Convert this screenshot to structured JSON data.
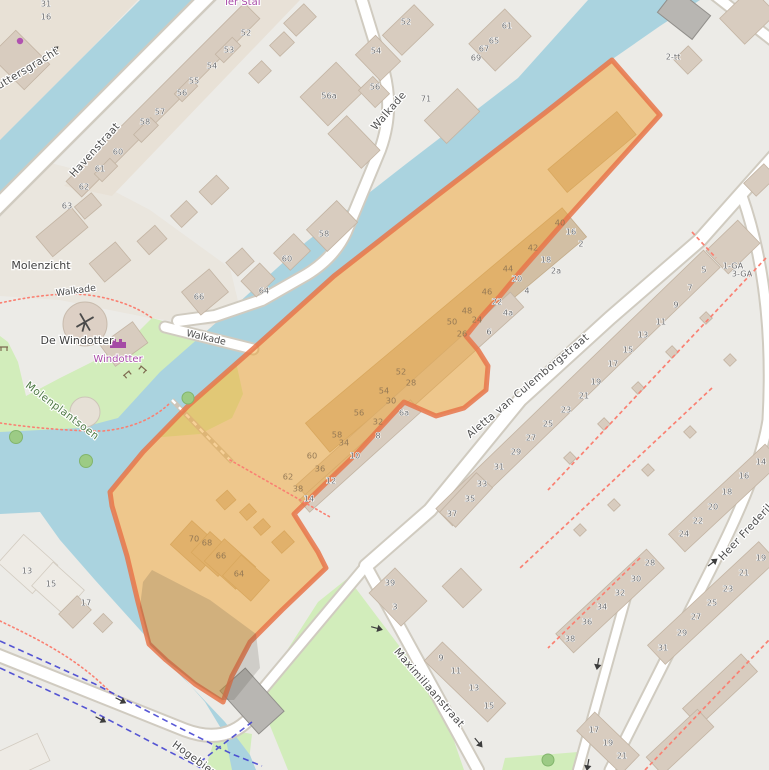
{
  "map": {
    "type": "openstreetmap-with-selection",
    "selection": {
      "name": "highlighted-area",
      "fill": "#f0a431",
      "stroke": "#e8764a"
    },
    "colors": {
      "water": "#aad3df",
      "park": "#d2edbb",
      "land": "#ecebe7",
      "residential": "#e7ddd0",
      "building": "#d8ccbf",
      "building_outline": "#c3b4a3",
      "road": "#ffffff",
      "road_casing": "#d0cbc0",
      "bridge": "#b8b6b2",
      "footpath_red": "#fa8072",
      "cycle_route_blue": "#3b3bd0",
      "poi_purple": "#a84ba8"
    },
    "street_labels": [
      {
        "t": "Havenstraat",
        "x": 95,
        "y": 150,
        "r": -48
      },
      {
        "t": "Schuttersgracht",
        "x": 19,
        "y": 74,
        "r": -31
      },
      {
        "t": "Walkade",
        "x": 389,
        "y": 111,
        "r": -49
      },
      {
        "t": "Aletta van Culemborgstraat",
        "x": 528,
        "y": 386,
        "r": -40
      },
      {
        "t": "Maximiliaanstraat",
        "x": 429,
        "y": 688,
        "r": 49
      },
      {
        "t": "Hogebiezen",
        "x": 200,
        "y": 763,
        "r": 36
      },
      {
        "t": "Heer Frederikstraat",
        "x": 758,
        "y": 519,
        "r": -47
      }
    ],
    "path_labels": [
      {
        "t": "Walkade",
        "x": 76,
        "y": 291,
        "r": -8
      },
      {
        "t": "Walkade",
        "x": 206,
        "y": 338,
        "r": 13
      }
    ],
    "place_labels": [
      {
        "t": "Molenzicht",
        "x": 41,
        "y": 266,
        "r": 0
      },
      {
        "t": "De Windotter",
        "x": 77,
        "y": 341,
        "r": 0
      }
    ],
    "park_labels": [
      {
        "t": "Molenplantsoen",
        "x": 62,
        "y": 411,
        "r": 37
      }
    ],
    "poi_labels": [
      {
        "t": "Ter Stal",
        "x": 242,
        "y": 2,
        "r": 0
      },
      {
        "t": "Windotter",
        "x": 118,
        "y": 359,
        "r": 0
      }
    ],
    "house_numbers": [
      {
        "t": "31",
        "x": 46,
        "y": 4
      },
      {
        "t": "16",
        "x": 46,
        "y": 17
      },
      {
        "t": "52",
        "x": 246,
        "y": 33
      },
      {
        "t": "53",
        "x": 229,
        "y": 50
      },
      {
        "t": "54",
        "x": 212,
        "y": 66
      },
      {
        "t": "55",
        "x": 194,
        "y": 81
      },
      {
        "t": "56",
        "x": 182,
        "y": 93
      },
      {
        "t": "57",
        "x": 160,
        "y": 112
      },
      {
        "t": "58",
        "x": 145,
        "y": 122
      },
      {
        "t": "60",
        "x": 118,
        "y": 152
      },
      {
        "t": "61",
        "x": 100,
        "y": 169
      },
      {
        "t": "62",
        "x": 84,
        "y": 187
      },
      {
        "t": "63",
        "x": 67,
        "y": 206
      },
      {
        "t": "66",
        "x": 199,
        "y": 297
      },
      {
        "t": "52",
        "x": 406,
        "y": 22
      },
      {
        "t": "54",
        "x": 376,
        "y": 51
      },
      {
        "t": "56",
        "x": 375,
        "y": 87
      },
      {
        "t": "56a",
        "x": 329,
        "y": 96
      },
      {
        "t": "71",
        "x": 426,
        "y": 99
      },
      {
        "t": "61",
        "x": 507,
        "y": 26
      },
      {
        "t": "65",
        "x": 494,
        "y": 41
      },
      {
        "t": "67",
        "x": 484,
        "y": 49
      },
      {
        "t": "69",
        "x": 476,
        "y": 58
      },
      {
        "t": "58",
        "x": 324,
        "y": 234
      },
      {
        "t": "60",
        "x": 287,
        "y": 259
      },
      {
        "t": "64",
        "x": 264,
        "y": 291
      },
      {
        "t": "2-tt",
        "x": 673,
        "y": 57
      },
      {
        "t": "40",
        "x": 560,
        "y": 223,
        "m": 1
      },
      {
        "t": "16",
        "x": 571,
        "y": 232
      },
      {
        "t": "2",
        "x": 581,
        "y": 244
      },
      {
        "t": "42",
        "x": 533,
        "y": 248,
        "m": 1
      },
      {
        "t": "18",
        "x": 546,
        "y": 260
      },
      {
        "t": "2a",
        "x": 556,
        "y": 271
      },
      {
        "t": "44",
        "x": 508,
        "y": 269,
        "m": 1
      },
      {
        "t": "20",
        "x": 517,
        "y": 279
      },
      {
        "t": "4",
        "x": 527,
        "y": 291
      },
      {
        "t": "46",
        "x": 487,
        "y": 292,
        "m": 1
      },
      {
        "t": "22",
        "x": 497,
        "y": 302
      },
      {
        "t": "4a",
        "x": 508,
        "y": 313
      },
      {
        "t": "48",
        "x": 467,
        "y": 311,
        "m": 1
      },
      {
        "t": "24",
        "x": 477,
        "y": 320,
        "m": 1
      },
      {
        "t": "50",
        "x": 452,
        "y": 322,
        "m": 1
      },
      {
        "t": "26",
        "x": 462,
        "y": 334,
        "m": 1
      },
      {
        "t": "6",
        "x": 489,
        "y": 332
      },
      {
        "t": "52",
        "x": 401,
        "y": 372,
        "m": 1
      },
      {
        "t": "28",
        "x": 411,
        "y": 383,
        "m": 1
      },
      {
        "t": "54",
        "x": 384,
        "y": 391,
        "m": 1
      },
      {
        "t": "30",
        "x": 391,
        "y": 401,
        "m": 1
      },
      {
        "t": "6a",
        "x": 404,
        "y": 413
      },
      {
        "t": "56",
        "x": 359,
        "y": 413,
        "m": 1
      },
      {
        "t": "32",
        "x": 378,
        "y": 422,
        "m": 1
      },
      {
        "t": "8",
        "x": 378,
        "y": 436
      },
      {
        "t": "58",
        "x": 337,
        "y": 435,
        "m": 1
      },
      {
        "t": "34",
        "x": 344,
        "y": 443,
        "m": 1
      },
      {
        "t": "10",
        "x": 355,
        "y": 456
      },
      {
        "t": "60",
        "x": 312,
        "y": 456,
        "m": 1
      },
      {
        "t": "36",
        "x": 320,
        "y": 469,
        "m": 1
      },
      {
        "t": "62",
        "x": 288,
        "y": 477,
        "m": 1
      },
      {
        "t": "12",
        "x": 331,
        "y": 481
      },
      {
        "t": "38",
        "x": 298,
        "y": 489,
        "m": 1
      },
      {
        "t": "14",
        "x": 309,
        "y": 499
      },
      {
        "t": "70",
        "x": 194,
        "y": 539,
        "m": 1
      },
      {
        "t": "68",
        "x": 207,
        "y": 543,
        "m": 1
      },
      {
        "t": "66",
        "x": 221,
        "y": 556,
        "m": 1
      },
      {
        "t": "64",
        "x": 239,
        "y": 574,
        "m": 1
      },
      {
        "t": "1-GA",
        "x": 733,
        "y": 266
      },
      {
        "t": "3-GA",
        "x": 742,
        "y": 274
      },
      {
        "t": "5",
        "x": 704,
        "y": 270
      },
      {
        "t": "7",
        "x": 690,
        "y": 288
      },
      {
        "t": "9",
        "x": 676,
        "y": 305
      },
      {
        "t": "11",
        "x": 661,
        "y": 322
      },
      {
        "t": "13",
        "x": 643,
        "y": 335
      },
      {
        "t": "15",
        "x": 628,
        "y": 350
      },
      {
        "t": "17",
        "x": 613,
        "y": 364
      },
      {
        "t": "19",
        "x": 596,
        "y": 382
      },
      {
        "t": "21",
        "x": 584,
        "y": 396
      },
      {
        "t": "23",
        "x": 566,
        "y": 410
      },
      {
        "t": "25",
        "x": 548,
        "y": 424
      },
      {
        "t": "27",
        "x": 531,
        "y": 438
      },
      {
        "t": "29",
        "x": 516,
        "y": 452
      },
      {
        "t": "31",
        "x": 499,
        "y": 467
      },
      {
        "t": "33",
        "x": 482,
        "y": 484
      },
      {
        "t": "35",
        "x": 470,
        "y": 499
      },
      {
        "t": "37",
        "x": 452,
        "y": 514
      },
      {
        "t": "39",
        "x": 390,
        "y": 583
      },
      {
        "t": "3",
        "x": 395,
        "y": 607
      },
      {
        "t": "13",
        "x": 27,
        "y": 571
      },
      {
        "t": "15",
        "x": 51,
        "y": 584
      },
      {
        "t": "17",
        "x": 86,
        "y": 603
      },
      {
        "t": "14",
        "x": 761,
        "y": 462
      },
      {
        "t": "16",
        "x": 744,
        "y": 476
      },
      {
        "t": "18",
        "x": 727,
        "y": 492
      },
      {
        "t": "20",
        "x": 713,
        "y": 507
      },
      {
        "t": "22",
        "x": 698,
        "y": 521
      },
      {
        "t": "24",
        "x": 684,
        "y": 534
      },
      {
        "t": "19",
        "x": 761,
        "y": 558
      },
      {
        "t": "21",
        "x": 744,
        "y": 573
      },
      {
        "t": "23",
        "x": 728,
        "y": 589
      },
      {
        "t": "25",
        "x": 712,
        "y": 603
      },
      {
        "t": "27",
        "x": 696,
        "y": 617
      },
      {
        "t": "29",
        "x": 682,
        "y": 633
      },
      {
        "t": "31",
        "x": 663,
        "y": 648
      },
      {
        "t": "28",
        "x": 650,
        "y": 563
      },
      {
        "t": "30",
        "x": 636,
        "y": 579
      },
      {
        "t": "32",
        "x": 620,
        "y": 593
      },
      {
        "t": "34",
        "x": 602,
        "y": 607
      },
      {
        "t": "36",
        "x": 587,
        "y": 622
      },
      {
        "t": "38",
        "x": 570,
        "y": 639
      },
      {
        "t": "9",
        "x": 441,
        "y": 658
      },
      {
        "t": "11",
        "x": 456,
        "y": 671
      },
      {
        "t": "13",
        "x": 474,
        "y": 688
      },
      {
        "t": "15",
        "x": 489,
        "y": 706
      },
      {
        "t": "17",
        "x": 594,
        "y": 730
      },
      {
        "t": "19",
        "x": 608,
        "y": 743
      },
      {
        "t": "21",
        "x": 622,
        "y": 756
      }
    ]
  }
}
